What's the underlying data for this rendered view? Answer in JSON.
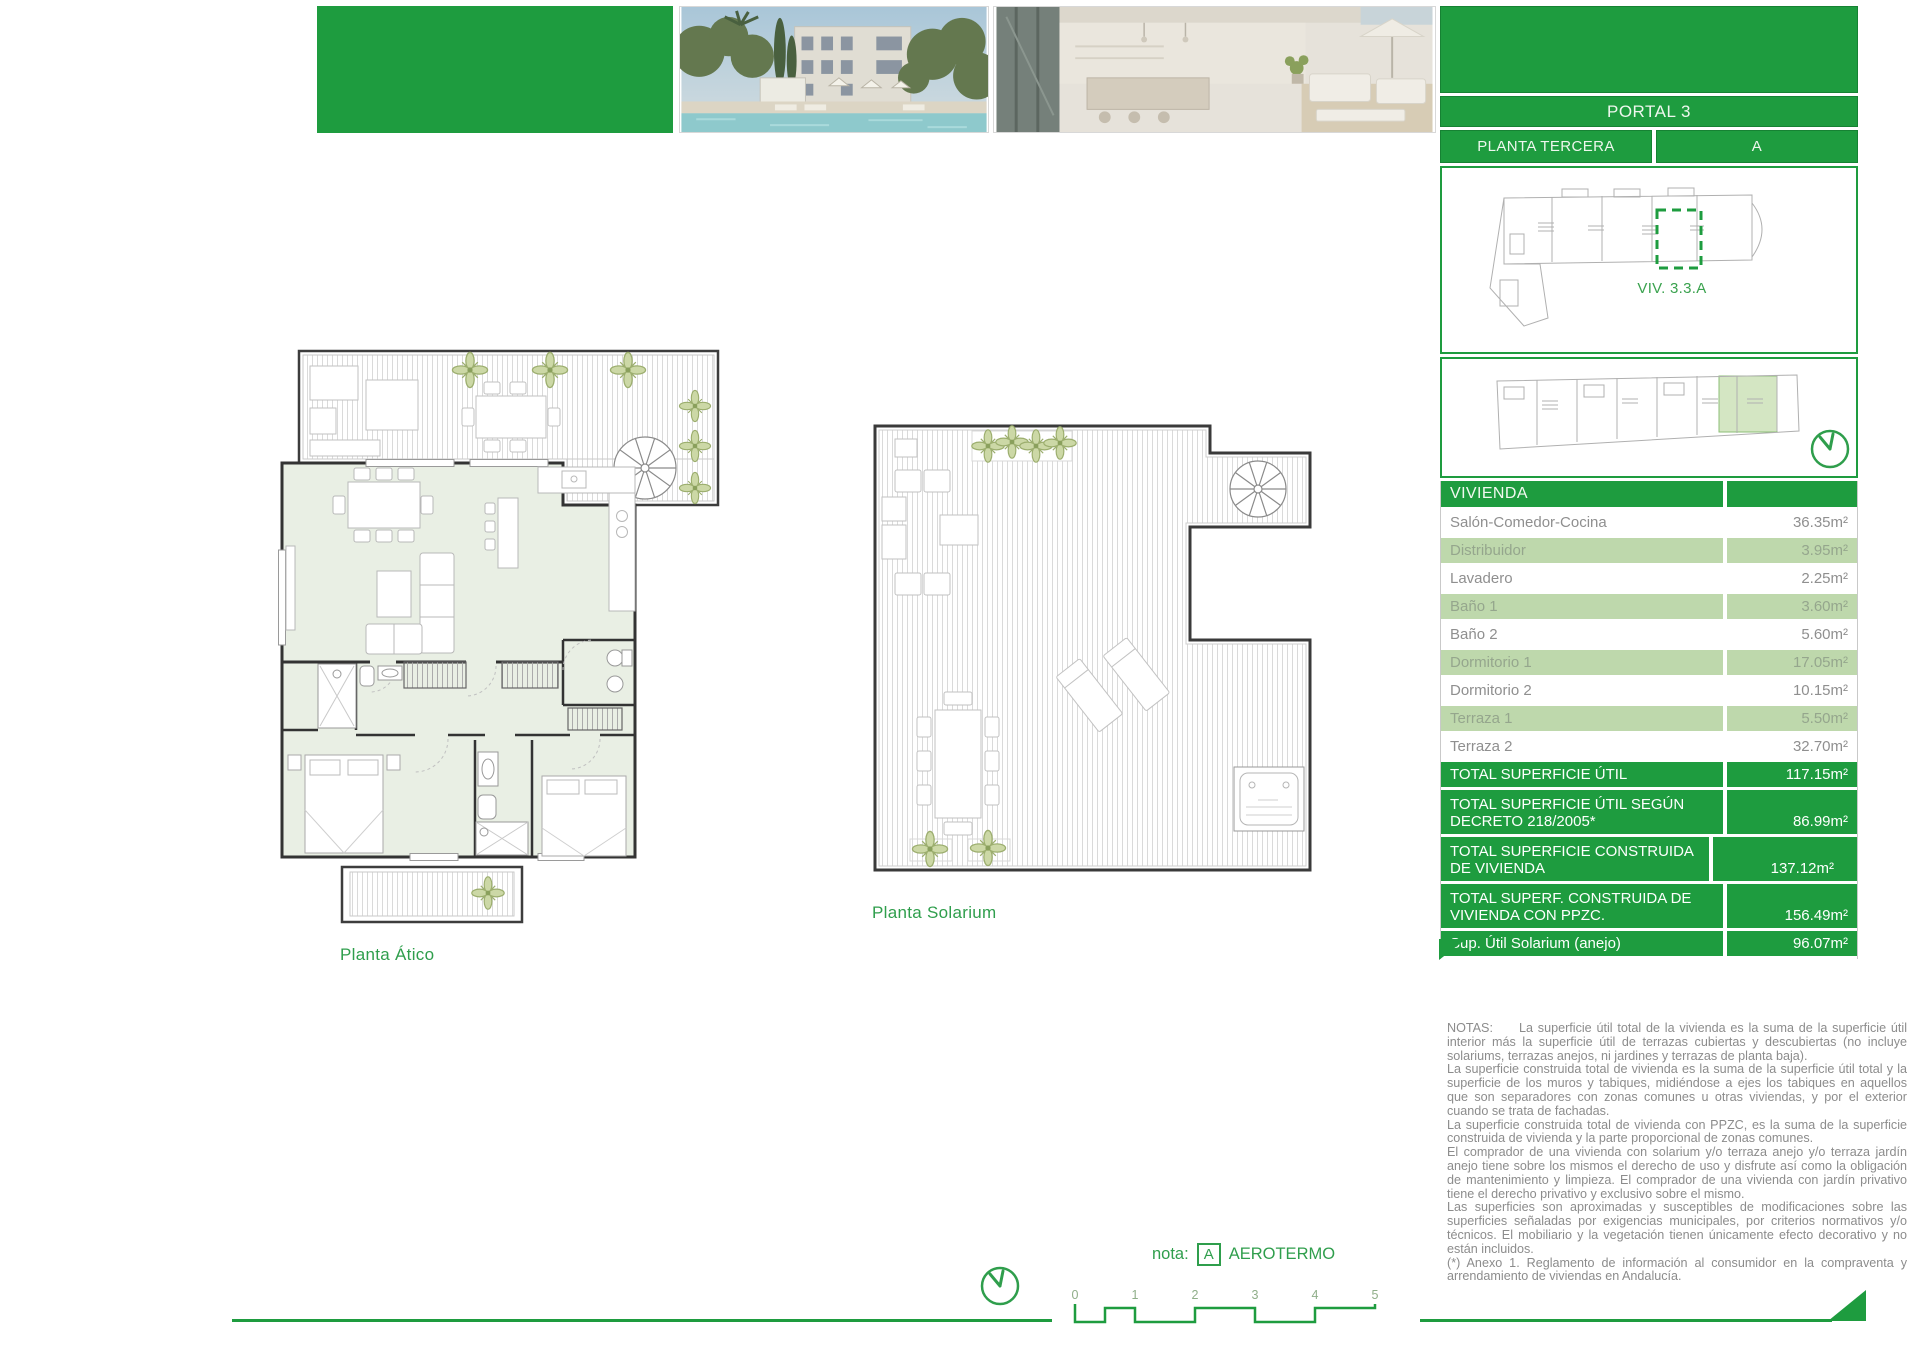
{
  "colors": {
    "primary_green": "#1e9c3f",
    "row_light_green": "#bed8ac",
    "plan_interior_green": "#e9efe4",
    "accent_text_green": "#2f9e4c"
  },
  "header": {
    "portal_label": "PORTAL 3",
    "floor_label": "PLANTA TERCERA",
    "unit_letter": "A",
    "unit_ref": "VIV. 3.3.A"
  },
  "area_table": {
    "section_header": "VIVIENDA",
    "rows": [
      {
        "label": "Salón-Comedor-Cocina",
        "value": "36.35m²"
      },
      {
        "label": "Distribuidor",
        "value": "3.95m²"
      },
      {
        "label": "Lavadero",
        "value": "2.25m²"
      },
      {
        "label": "Baño 1",
        "value": "3.60m²"
      },
      {
        "label": "Baño 2",
        "value": "5.60m²"
      },
      {
        "label": "Dormitorio 1",
        "value": "17.05m²"
      },
      {
        "label": "Dormitorio 2",
        "value": "10.15m²"
      },
      {
        "label": "Terraza 1",
        "value": "5.50m²"
      },
      {
        "label": "Terraza 2",
        "value": "32.70m²"
      }
    ],
    "totals": [
      {
        "label": "TOTAL SUPERFICIE ÚTIL",
        "value": "117.15m²"
      },
      {
        "label": "TOTAL SUPERFICIE ÚTIL SEGÚN DECRETO 218/2005*",
        "value": "86.99m²"
      },
      {
        "label": "TOTAL SUPERFICIE CONSTRUIDA DE VIVIENDA",
        "value": "137.12m²"
      },
      {
        "label": "TOTAL SUPERF. CONSTRUIDA DE VIVIENDA CON PPZC.",
        "value": "156.49m²"
      },
      {
        "label": "Sup. Útil Solarium (anejo)",
        "value": "96.07m²"
      }
    ]
  },
  "plan_labels": {
    "atico": "Planta Ático",
    "solarium": "Planta Solarium"
  },
  "nota": {
    "prefix": "nota:",
    "badge": "A",
    "label": "AEROTERMO"
  },
  "scale_bar": {
    "ticks": [
      "0",
      "1",
      "2",
      "3",
      "4",
      "5"
    ]
  },
  "notes": {
    "heading": "NOTAS:",
    "paragraphs": [
      "La superficie útil total de la vivienda es la suma de la superficie útil interior más la superficie útil de terrazas cubiertas y descubiertas (no incluye solariums, terrazas anejos, ni jardines y terrazas de planta baja).",
      "La superficie construida total de vivienda es la suma de la superficie útil total y la superficie de los muros y tabiques, midiéndose a ejes los tabiques en aquellos que son separadores con zonas comunes u otras viviendas, y por el exterior cuando se trata de fachadas.",
      "La superficie construida total de vivienda con PPZC, es la suma de la superficie construida de vivienda y la parte proporcional de zonas comunes.",
      "El comprador de una vivienda con solarium y/o terraza anejo y/o terraza jardín anejo tiene sobre los mismos el derecho de uso y disfrute así como la obligación de mantenimiento y limpieza. El comprador de una vivienda con jardín privativo tiene el derecho privativo y exclusivo sobre el mismo.",
      "Las superficies son aproximadas y susceptibles de modificaciones sobre las superficies señaladas por exigencias municipales, por criterios normativos y/o técnicos. El mobiliario y la vegetación tienen únicamente efecto decorativo y no están incluidos.",
      "(*) Anexo 1. Reglamento de información al consumidor en la compraventa y arrendamiento de viviendas en Andalucía."
    ]
  }
}
